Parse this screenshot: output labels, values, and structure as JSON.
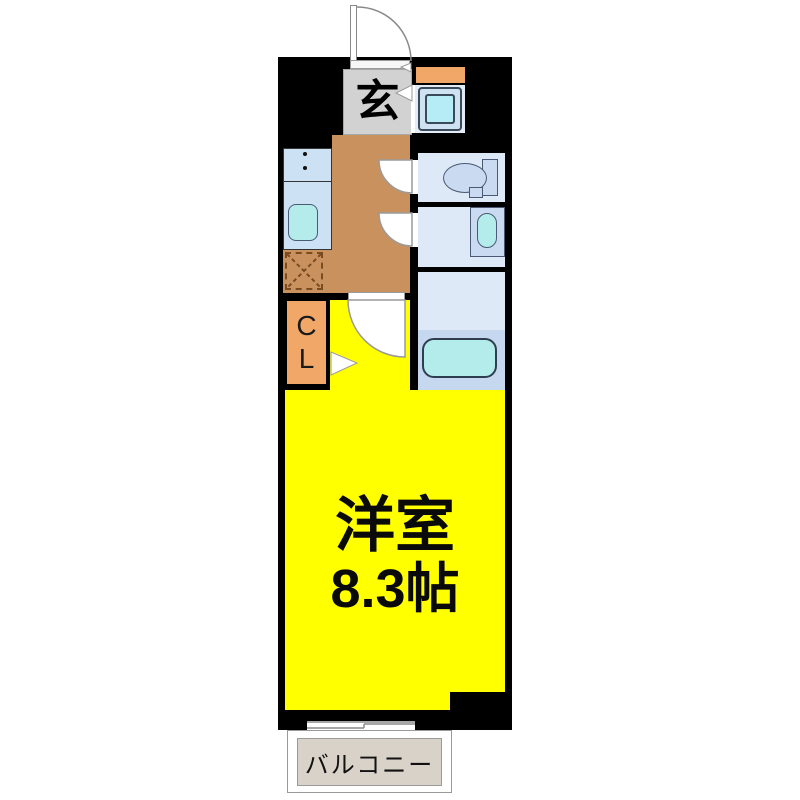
{
  "floorplan": {
    "type": "apartment-1K-floor-plan",
    "rooms": {
      "genkan": {
        "label": "玄"
      },
      "closet": {
        "lines": [
          "C",
          "L"
        ]
      },
      "western_room": {
        "name": "洋室",
        "size": "8.3帖"
      },
      "balcony": {
        "label": "バルコニー"
      }
    },
    "fixtures": [
      "entrance-door",
      "washing-machine",
      "toilet",
      "vanity-basin",
      "bathtub",
      "kitchen-sink",
      "stove",
      "refrigerator-space",
      "sliding-window"
    ],
    "colors": {
      "wall": "#000000",
      "room_yellow": "#ffff00",
      "hallway_tan": "#c9915e",
      "accent_orange": "#f0a767",
      "genkan_gray": "#d2d2d2",
      "wet_room_floor": "#dde9f7",
      "fixture_blue": "#c9daf1",
      "kitchen_counter": "#cde1f4",
      "water_cyan": "#b4ecec",
      "bath_lower": "#c6d8ef",
      "balcony_beige": "#d9d2c9",
      "dash_brown": "#7a4a21"
    }
  }
}
